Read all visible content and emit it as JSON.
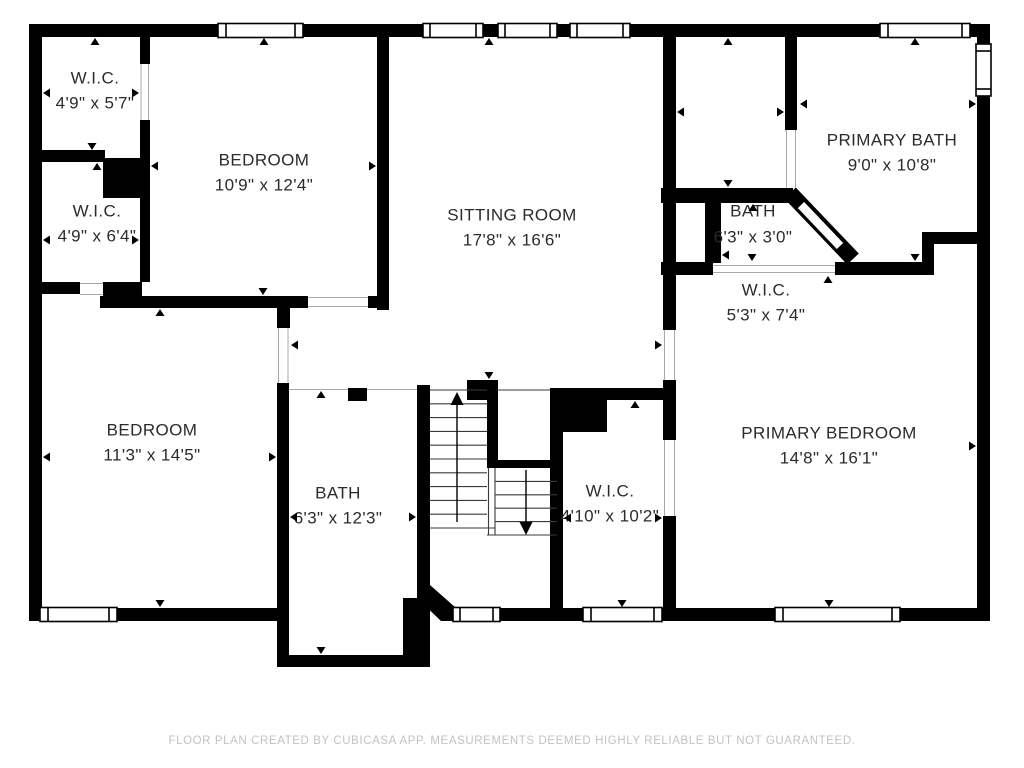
{
  "title": "Floor plan",
  "colors": {
    "wall": "#000000",
    "label_text": "#2b2b2b",
    "footer_text": "#c2c2c2",
    "background": "#ffffff",
    "stair_line": "#3a3a3a",
    "jamb_line": "#a8a8a8"
  },
  "footer": {
    "text": "FLOOR PLAN CREATED BY CUBICASA APP. MEASUREMENTS DEEMED HIGHLY RELIABLE BUT NOT GUARANTEED."
  },
  "stairs": {
    "up_arrow": "up",
    "down_arrow": "down"
  },
  "rooms": [
    {
      "id": "wic-top-left",
      "name": "W.I.C.",
      "dims": "4'9\" x 5'7\"",
      "label": {
        "x": 95,
        "y": 79,
        "dims_y": 104
      },
      "arrows": [
        {
          "dir": "up",
          "x": 95,
          "y": 38
        },
        {
          "dir": "down",
          "x": 92,
          "y": 150
        },
        {
          "dir": "left",
          "x": 43,
          "y": 93
        },
        {
          "dir": "right",
          "x": 139,
          "y": 93
        }
      ]
    },
    {
      "id": "bedroom-top",
      "name": "BEDROOM",
      "dims": "10'9\" x 12'4\"",
      "label": {
        "x": 264,
        "y": 161,
        "dims_y": 186
      },
      "arrows": [
        {
          "dir": "up",
          "x": 264,
          "y": 38
        },
        {
          "dir": "down",
          "x": 263,
          "y": 295
        },
        {
          "dir": "left",
          "x": 151,
          "y": 166
        },
        {
          "dir": "right",
          "x": 376,
          "y": 166
        }
      ]
    },
    {
      "id": "wic-left",
      "name": "W.I.C.",
      "dims": "4'9\" x 6'4\"",
      "label": {
        "x": 97,
        "y": 212,
        "dims_y": 237
      },
      "arrows": [
        {
          "dir": "up",
          "x": 97,
          "y": 163
        },
        {
          "dir": "left",
          "x": 43,
          "y": 240
        },
        {
          "dir": "right",
          "x": 139,
          "y": 240
        }
      ]
    },
    {
      "id": "sitting-room",
      "name": "SITTING ROOM",
      "dims": "17'8\" x 16'6\"",
      "label": {
        "x": 512,
        "y": 216,
        "dims_y": 241
      },
      "arrows": [
        {
          "dir": "up",
          "x": 489,
          "y": 38
        },
        {
          "dir": "down",
          "x": 489,
          "y": 379
        },
        {
          "dir": "left",
          "x": 291,
          "y": 345
        },
        {
          "dir": "right",
          "x": 662,
          "y": 345
        }
      ]
    },
    {
      "id": "primary-bath",
      "name": "PRIMARY BATH",
      "dims": "9'0\" x 10'8\"",
      "label": {
        "x": 892,
        "y": 141,
        "dims_y": 166
      },
      "arrows": [
        {
          "dir": "up",
          "x": 915,
          "y": 38
        },
        {
          "dir": "down",
          "x": 915,
          "y": 261
        },
        {
          "dir": "left",
          "x": 800,
          "y": 104
        },
        {
          "dir": "right",
          "x": 976,
          "y": 104
        }
      ]
    },
    {
      "id": "water-closet",
      "name": "",
      "dims": "",
      "label": {
        "x": 729,
        "y": 100,
        "dims_y": 120
      },
      "arrows": [
        {
          "dir": "up",
          "x": 728,
          "y": 38
        },
        {
          "dir": "down",
          "x": 728,
          "y": 187
        },
        {
          "dir": "left",
          "x": 677,
          "y": 112
        },
        {
          "dir": "right",
          "x": 784,
          "y": 112
        }
      ]
    },
    {
      "id": "bath-small",
      "name": "BATH",
      "dims": "6'3\" x 3'0\"",
      "label": {
        "x": 753,
        "y": 212,
        "dims_y": 238
      },
      "arrows": [
        {
          "dir": "up",
          "x": 753,
          "y": 204
        },
        {
          "dir": "down",
          "x": 752,
          "y": 261
        },
        {
          "dir": "left",
          "x": 722,
          "y": 255
        }
      ]
    },
    {
      "id": "wic-primary-hall",
      "name": "W.I.C.",
      "dims": "5'3\" x 7'4\"",
      "label": {
        "x": 766,
        "y": 291,
        "dims_y": 316
      },
      "arrows": [
        {
          "dir": "up",
          "x": 828,
          "y": 276
        }
      ]
    },
    {
      "id": "bedroom-left",
      "name": "BEDROOM",
      "dims": "11'3\" x 14'5\"",
      "label": {
        "x": 152,
        "y": 431,
        "dims_y": 456
      },
      "arrows": [
        {
          "dir": "up",
          "x": 160,
          "y": 309
        },
        {
          "dir": "down",
          "x": 160,
          "y": 607
        },
        {
          "dir": "left",
          "x": 43,
          "y": 457
        },
        {
          "dir": "right",
          "x": 276,
          "y": 457
        }
      ]
    },
    {
      "id": "bath-middle",
      "name": "BATH",
      "dims": "6'3\" x 12'3\"",
      "label": {
        "x": 338,
        "y": 494,
        "dims_y": 519
      },
      "arrows": [
        {
          "dir": "up",
          "x": 321,
          "y": 391
        },
        {
          "dir": "down",
          "x": 321,
          "y": 654
        },
        {
          "dir": "left",
          "x": 290,
          "y": 517
        },
        {
          "dir": "right",
          "x": 416,
          "y": 517
        }
      ]
    },
    {
      "id": "wic-center",
      "name": "W.I.C.",
      "dims": "4'10\" x 10'2\"",
      "label": {
        "x": 610,
        "y": 492,
        "dims_y": 517
      },
      "arrows": [
        {
          "dir": "up",
          "x": 635,
          "y": 401
        },
        {
          "dir": "down",
          "x": 622,
          "y": 607
        },
        {
          "dir": "left",
          "x": 564,
          "y": 518
        },
        {
          "dir": "right",
          "x": 662,
          "y": 518
        }
      ]
    },
    {
      "id": "primary-bedroom",
      "name": "PRIMARY BEDROOM",
      "dims": "14'8\" x 16'1\"",
      "label": {
        "x": 829,
        "y": 434,
        "dims_y": 459
      },
      "arrows": [
        {
          "dir": "down",
          "x": 829,
          "y": 607
        },
        {
          "dir": "right",
          "x": 976,
          "y": 446
        }
      ]
    }
  ]
}
